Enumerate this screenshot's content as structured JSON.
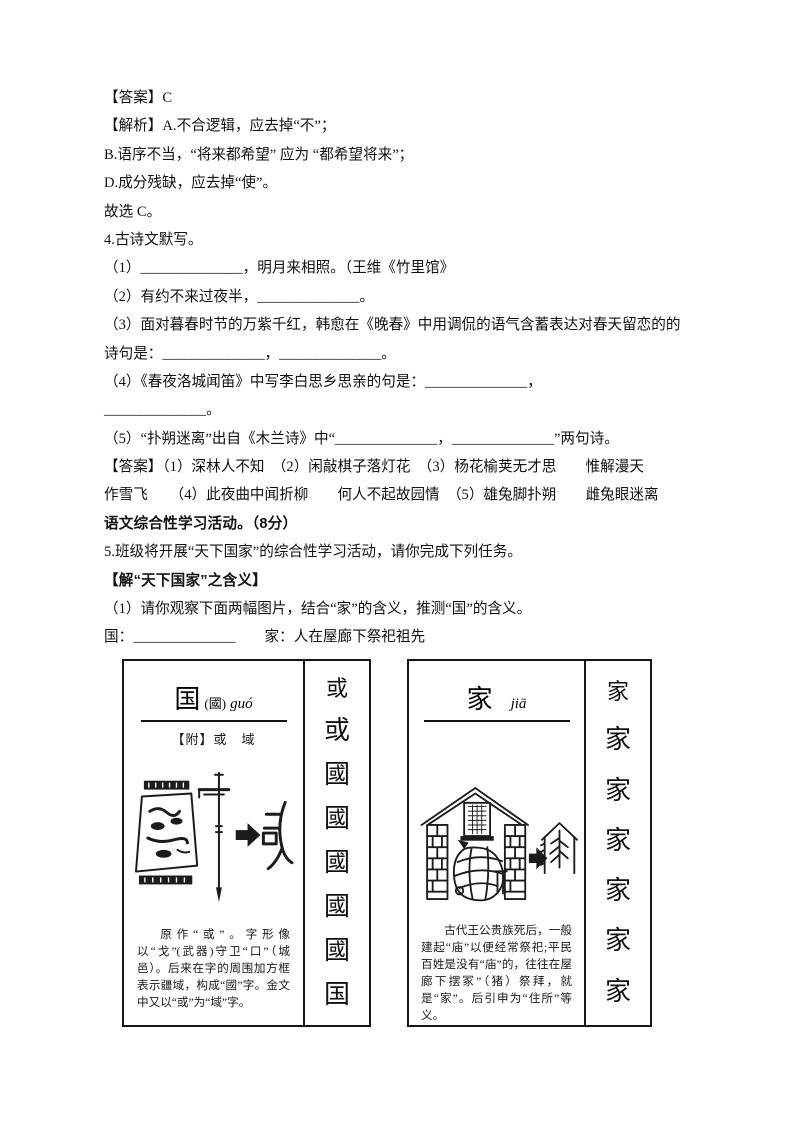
{
  "q3": {
    "answer_line": "【答案】C",
    "analysis_line_a": "【解析】A.不合逻辑，应去掉“不”；",
    "analysis_line_b": "B.语序不当，“将来都希望” 应为 “都希望将来”；",
    "analysis_line_d": "D.成分残缺，应去掉“使”。",
    "conclusion_line": "故选 C。"
  },
  "q4": {
    "title_line": "4.古诗文默写。",
    "item1_line": "（1）______________，明月来相照。（王维《竹里馆》",
    "item2_line": "（2）有约不来过夜半，______________。",
    "item3_line1": "（3）面对暮春时节的万紫千红，韩愈在《晚春》中用调侃的语气含蓄表达对春天留恋的的",
    "item3_line2": "诗句是：______________，______________。",
    "item4_line1": "（4）《春夜洛城闻笛》中写李白思乡思亲的句是：______________，",
    "item4_line2": "______________。",
    "item5_line": "（5）“扑朔迷离”出自《木兰诗》中“______________，______________”两句诗。",
    "answer_line1": "【答案】（1）深林人不知　（2）闲敲棋子落灯花　（3）杨花榆荚无才思　　惟解漫天",
    "answer_line2": "作雪飞　　（4）此夜曲中闻折柳　　何人不起故园情　（5）雄兔脚扑朔　　雌兔眼迷离"
  },
  "activity": {
    "section_line": "语文综合性学习活动。（8分）",
    "q5_line": "5.班级将开展“天下国家”的综合性学习活动，请你完成下列任务。",
    "subhead_line": "【解“天下国家”之含义】",
    "task_line": "（1）请你观察下面两幅图片，结合“家”的含义，推测“国”的含义。",
    "fill_line": "国：______________　　家：人在屋廊下祭祀祖先"
  },
  "guo_card": {
    "headword": "国",
    "traditional": "(國)",
    "pinyin": "guó",
    "variants_line": "【附】或　域",
    "caption": "原作“或”。字形像以“戈”(武器)守卫“口”（城邑）。后来在字的周围加方框表示疆域，构成“國”字。金文中又以“或”为“域”字。",
    "strip_glyphs": [
      "或",
      "或",
      "國",
      "國",
      "國",
      "國",
      "國",
      "国"
    ]
  },
  "jia_card": {
    "headword": "家",
    "pinyin": "jiā",
    "caption": "古代王公贵族死后，一般建起“庙”以便经常祭祀;平民百姓是没有“庙”的，往往在屋廊下摆冢”（猪）祭拜，就是“家”。后引申为“住所”等义。",
    "strip_glyphs": [
      "家",
      "家",
      "家",
      "家",
      "家",
      "家",
      "家"
    ]
  },
  "icons": {
    "evolution_arrow": "black right arrow"
  },
  "colors": {
    "ink": "#111111",
    "paper": "#ffffff",
    "border": "#161616"
  }
}
